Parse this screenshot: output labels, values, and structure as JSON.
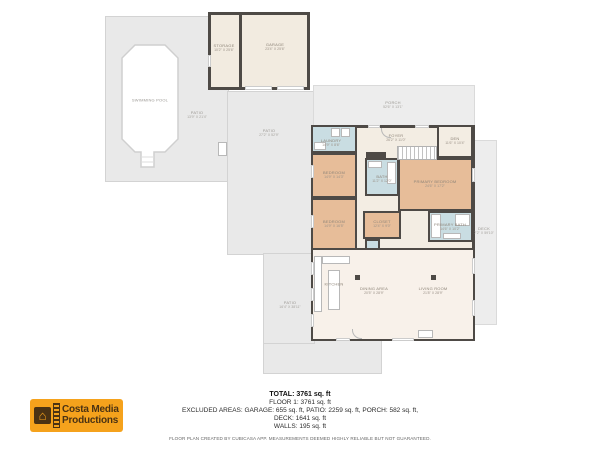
{
  "colors": {
    "wall": "#4e4a46",
    "patio_gray": "#e9e9e9",
    "porch_gray": "#ededed",
    "bedroom_tan": "#e7bd99",
    "bath_blue": "#c9dde2",
    "room_cream": "#f3ede3",
    "living_cream": "#f8f1ea",
    "logo_bg": "#f5a21c",
    "logo_text": "#4a3213"
  },
  "rooms": {
    "swimming_pool": {
      "label": "SWIMMING POOL"
    },
    "patio_upper": {
      "label": "PATIO",
      "dims": "13'9\" x 21'4\""
    },
    "patio_mid": {
      "label": "PATIO",
      "dims": "27'2\" x 52'9\""
    },
    "patio_lower": {
      "label": "PATIO",
      "dims": "16'4\" x 38'11\""
    },
    "porch": {
      "label": "PORCH",
      "dims": "52'6\" x 13'1\""
    },
    "deck": {
      "label": "DECK",
      "dims": "7'2\" x 59'10\""
    },
    "garage": {
      "label": "GARAGE",
      "dims": "23'4\" x 25'6\""
    },
    "storage": {
      "label": "STORAGE",
      "dims": "10'2\" x 25'6\""
    },
    "laundry": {
      "label": "LAUNDRY",
      "dims": "14'9\" x 8'6\""
    },
    "foyer": {
      "label": "FOYER",
      "dims": "26'2\" x 11'0\""
    },
    "den": {
      "label": "DEN",
      "dims": "11'6\" x 10'4\""
    },
    "bedroom_2": {
      "label": "BEDROOM",
      "dims": "14'9\" x 14'3\""
    },
    "bedroom_3": {
      "label": "BEDROOM",
      "dims": "14'9\" x 16'5\""
    },
    "bath_2": {
      "label": "BATH",
      "dims": "11'2\" x 12'0\""
    },
    "primary_bedroom": {
      "label": "PRIMARY BEDROOM",
      "dims": "24'6\" x 17'2\""
    },
    "closet": {
      "label": "CLOSET",
      "dims": "12'4\" x 9'0\""
    },
    "primary_bath": {
      "label": "PRIMARY BATH",
      "dims": "14'6\" x 10'2\""
    },
    "kitchen": {
      "label": "KITCHEN"
    },
    "dining": {
      "label": "DINING AREA",
      "dims": "20'5\" x 28'9\""
    },
    "living": {
      "label": "LIVING ROOM",
      "dims": "21'8\" x 28'9\""
    }
  },
  "summary": {
    "total": "TOTAL: 3761 sq. ft",
    "floor": "FLOOR 1: 3761 sq. ft",
    "excluded": "EXCLUDED AREAS: GARAGE: 655 sq. ft, PATIO: 2259 sq. ft, PORCH: 582 sq. ft,",
    "deck": "DECK: 1641 sq. ft",
    "walls": "WALLS: 195 sq. ft",
    "disclaimer": "FLOOR PLAN CREATED BY CUBICASA APP. MEASUREMENTS DEEMED HIGHLY RELIABLE BUT NOT GUARANTEED."
  },
  "logo": {
    "line1": "Costa Media",
    "line2": "Productions"
  }
}
